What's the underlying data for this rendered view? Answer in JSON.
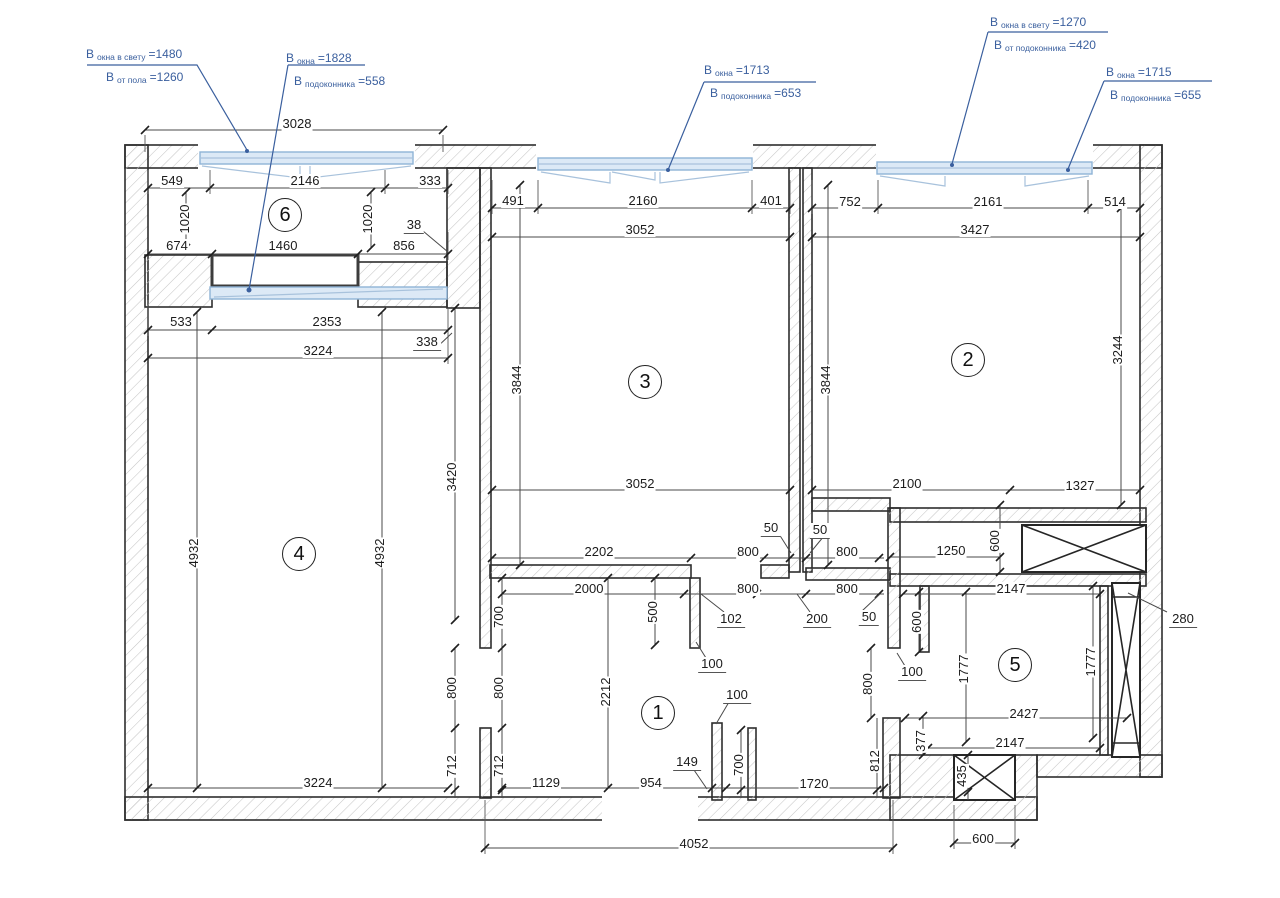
{
  "colors": {
    "annotation_blue": "#3a5f9e",
    "window_fill": "#dce9f6",
    "window_stroke": "#8fb3d6",
    "wall_outline": "#2e2e2e",
    "hatch_gray": "#c6c6c6",
    "dimension_text": "#1c1c1c"
  },
  "rooms": [
    {
      "n": "1",
      "x": 658,
      "y": 713
    },
    {
      "n": "2",
      "x": 968,
      "y": 360
    },
    {
      "n": "3",
      "x": 645,
      "y": 382
    },
    {
      "n": "4",
      "x": 299,
      "y": 554
    },
    {
      "n": "5",
      "x": 1015,
      "y": 665
    },
    {
      "n": "6",
      "x": 285,
      "y": 215
    }
  ],
  "annotations": [
    {
      "x": 86,
      "y": 44,
      "ind": 20,
      "l1": {
        "p": "В",
        "s": "окна в свету",
        "v": "=1480"
      },
      "l2": {
        "p": "В",
        "s": "от пола",
        "v": "=1260"
      }
    },
    {
      "x": 286,
      "y": 48,
      "ind": 8,
      "l1": {
        "p": "В",
        "s": "окна",
        "v": "=1828"
      },
      "l2": {
        "p": "В",
        "s": "подоконника",
        "v": "=558"
      }
    },
    {
      "x": 704,
      "y": 60,
      "ind": 6,
      "l1": {
        "p": "В",
        "s": "окна",
        "v": "=1713"
      },
      "l2": {
        "p": "В",
        "s": "подоконника",
        "v": "=653"
      }
    },
    {
      "x": 990,
      "y": 12,
      "ind": 4,
      "l1": {
        "p": "В",
        "s": "окна в свету",
        "v": "=1270"
      },
      "l2": {
        "p": "В",
        "s": "от подоконника",
        "v": "=420"
      }
    },
    {
      "x": 1106,
      "y": 62,
      "ind": 4,
      "l1": {
        "p": "В",
        "s": "окна",
        "v": "=1715"
      },
      "l2": {
        "p": "В",
        "s": "подоконника",
        "v": "=655"
      }
    }
  ],
  "dim_labels": [
    {
      "t": "3028",
      "x": 297,
      "y": 124
    },
    {
      "t": "549",
      "x": 172,
      "y": 181
    },
    {
      "t": "2146",
      "x": 305,
      "y": 181
    },
    {
      "t": "333",
      "x": 430,
      "y": 181
    },
    {
      "t": "1020",
      "x": 185,
      "y": 219,
      "r": 1
    },
    {
      "t": "1020",
      "x": 368,
      "y": 219,
      "r": 1
    },
    {
      "t": "38",
      "x": 414,
      "y": 226,
      "u": 1
    },
    {
      "t": "674",
      "x": 177,
      "y": 246
    },
    {
      "t": "1460",
      "x": 283,
      "y": 246
    },
    {
      "t": "856",
      "x": 404,
      "y": 246
    },
    {
      "t": "533",
      "x": 181,
      "y": 322
    },
    {
      "t": "2353",
      "x": 327,
      "y": 322
    },
    {
      "t": "338",
      "x": 427,
      "y": 343,
      "u": 1
    },
    {
      "t": "3224",
      "x": 318,
      "y": 351
    },
    {
      "t": "491",
      "x": 513,
      "y": 201
    },
    {
      "t": "2160",
      "x": 643,
      "y": 201
    },
    {
      "t": "401",
      "x": 771,
      "y": 201
    },
    {
      "t": "3052",
      "x": 640,
      "y": 230
    },
    {
      "t": "752",
      "x": 850,
      "y": 202
    },
    {
      "t": "2161",
      "x": 988,
      "y": 202
    },
    {
      "t": "514",
      "x": 1115,
      "y": 202
    },
    {
      "t": "3427",
      "x": 975,
      "y": 230
    },
    {
      "t": "3844",
      "x": 517,
      "y": 380,
      "r": 1
    },
    {
      "t": "3844",
      "x": 826,
      "y": 380,
      "r": 1
    },
    {
      "t": "3420",
      "x": 452,
      "y": 477,
      "r": 1
    },
    {
      "t": "3244",
      "x": 1118,
      "y": 350,
      "r": 1
    },
    {
      "t": "4932",
      "x": 194,
      "y": 553,
      "r": 1
    },
    {
      "t": "4932",
      "x": 380,
      "y": 553,
      "r": 1
    },
    {
      "t": "3052",
      "x": 640,
      "y": 484
    },
    {
      "t": "2100",
      "x": 907,
      "y": 484
    },
    {
      "t": "1327",
      "x": 1080,
      "y": 486
    },
    {
      "t": "50",
      "x": 771,
      "y": 529,
      "u": 1
    },
    {
      "t": "50",
      "x": 820,
      "y": 531,
      "u": 1
    },
    {
      "t": "2202",
      "x": 599,
      "y": 552
    },
    {
      "t": "800",
      "x": 748,
      "y": 552
    },
    {
      "t": "800",
      "x": 847,
      "y": 552
    },
    {
      "t": "1250",
      "x": 951,
      "y": 551
    },
    {
      "t": "600",
      "x": 995,
      "y": 541,
      "r": 1
    },
    {
      "t": "2000",
      "x": 589,
      "y": 589
    },
    {
      "t": "800",
      "x": 748,
      "y": 589
    },
    {
      "t": "800",
      "x": 847,
      "y": 589
    },
    {
      "t": "2147",
      "x": 1011,
      "y": 589
    },
    {
      "t": "700",
      "x": 499,
      "y": 617,
      "r": 1
    },
    {
      "t": "500",
      "x": 653,
      "y": 612,
      "r": 1
    },
    {
      "t": "102",
      "x": 731,
      "y": 620,
      "u": 1
    },
    {
      "t": "200",
      "x": 817,
      "y": 620,
      "u": 1
    },
    {
      "t": "50",
      "x": 869,
      "y": 618,
      "u": 1
    },
    {
      "t": "600",
      "x": 917,
      "y": 622,
      "r": 1
    },
    {
      "t": "100",
      "x": 712,
      "y": 665,
      "u": 1
    },
    {
      "t": "100",
      "x": 912,
      "y": 673,
      "u": 1
    },
    {
      "t": "800",
      "x": 868,
      "y": 684,
      "r": 1
    },
    {
      "t": "1777",
      "x": 964,
      "y": 669,
      "r": 1
    },
    {
      "t": "1777",
      "x": 1091,
      "y": 662,
      "r": 1
    },
    {
      "t": "2212",
      "x": 606,
      "y": 692,
      "r": 1
    },
    {
      "t": "100",
      "x": 737,
      "y": 696,
      "u": 1
    },
    {
      "t": "800",
      "x": 452,
      "y": 688,
      "r": 1
    },
    {
      "t": "800",
      "x": 499,
      "y": 688,
      "r": 1
    },
    {
      "t": "2427",
      "x": 1024,
      "y": 714
    },
    {
      "t": "712",
      "x": 452,
      "y": 766,
      "r": 1
    },
    {
      "t": "712",
      "x": 499,
      "y": 766,
      "r": 1
    },
    {
      "t": "377",
      "x": 921,
      "y": 741,
      "r": 1
    },
    {
      "t": "2147",
      "x": 1010,
      "y": 743
    },
    {
      "t": "149",
      "x": 687,
      "y": 763,
      "u": 1
    },
    {
      "t": "700",
      "x": 739,
      "y": 765,
      "r": 1
    },
    {
      "t": "812",
      "x": 875,
      "y": 761,
      "r": 1
    },
    {
      "t": "280",
      "x": 1183,
      "y": 620,
      "u": 1
    },
    {
      "t": "1129",
      "x": 546,
      "y": 783
    },
    {
      "t": "954",
      "x": 651,
      "y": 783
    },
    {
      "t": "1720",
      "x": 814,
      "y": 784
    },
    {
      "t": "3224",
      "x": 318,
      "y": 783
    },
    {
      "t": "435",
      "x": 962,
      "y": 776,
      "r": 1
    },
    {
      "t": "4052",
      "x": 694,
      "y": 844
    },
    {
      "t": "600",
      "x": 983,
      "y": 839
    }
  ]
}
